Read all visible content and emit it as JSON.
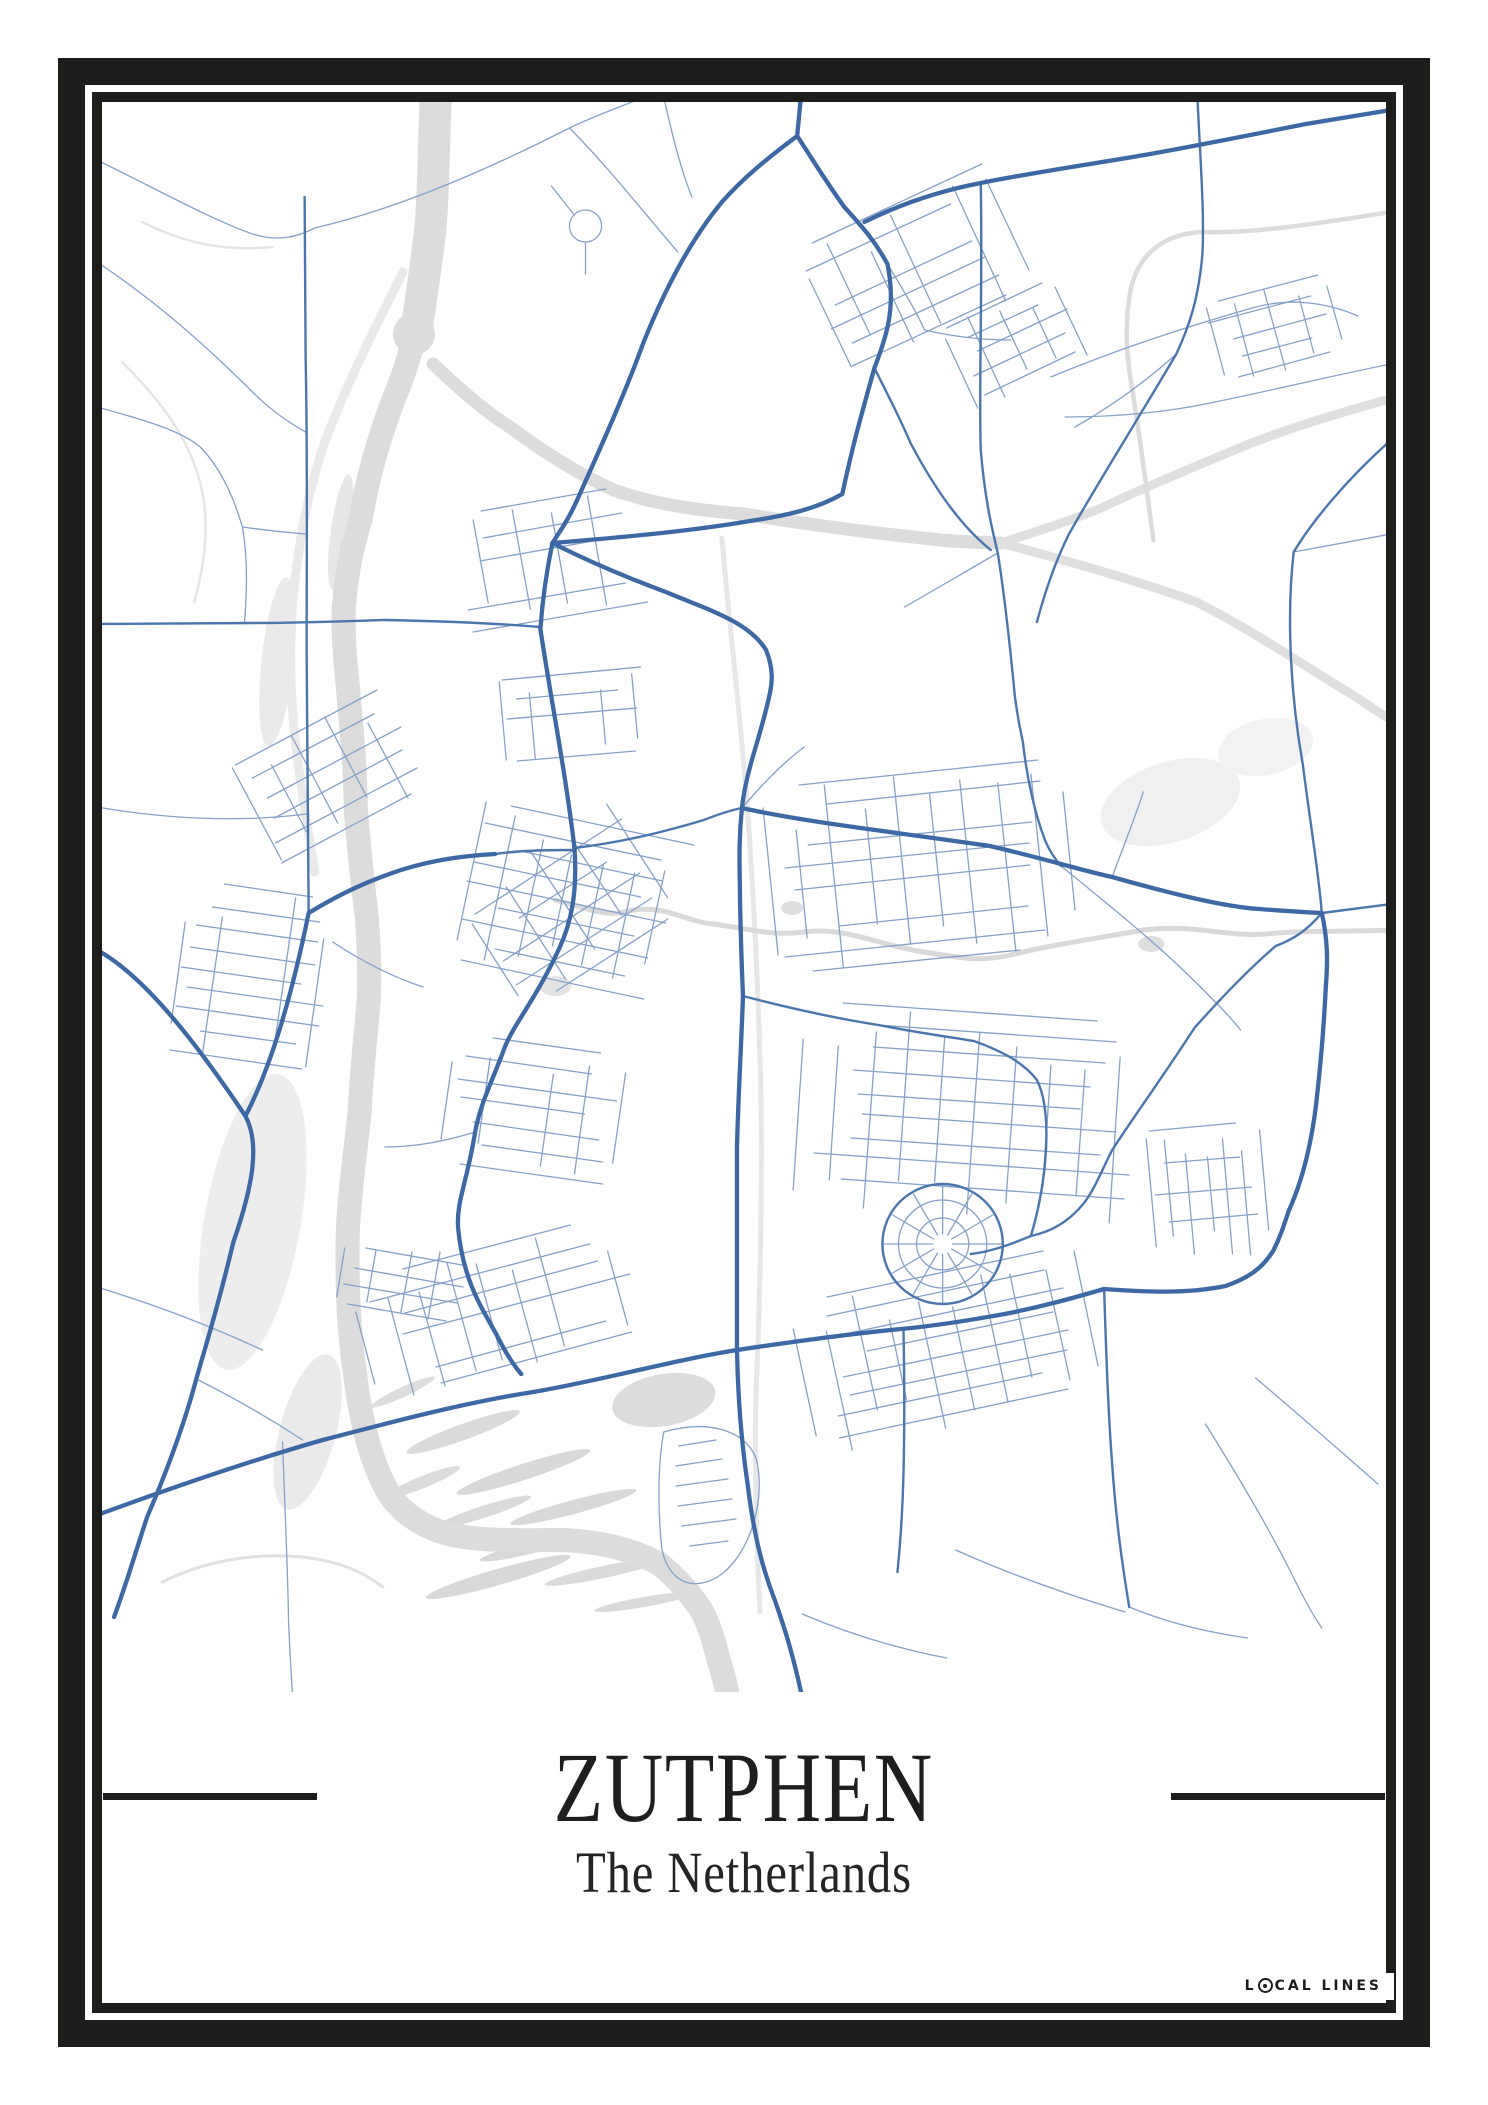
{
  "poster": {
    "title": "ZUTPHEN",
    "subtitle": "The Netherlands",
    "brand_pre": "L",
    "brand_post": "CAL LINES"
  },
  "colors": {
    "frame": "#1d1d1b",
    "text": "#1e1e1e",
    "background": "#ffffff",
    "road_major": "#3c69a5",
    "road_medium": "#4a76ad",
    "road_minor": "#86a0c8",
    "water_gray": "#dcdcdc"
  },
  "map": {
    "viewbox": "0 0 1280 1590",
    "fills": [
      {
        "cx": 311,
        "cy": 232,
        "rx": 21,
        "ry": 21,
        "rot": 0,
        "c": "#dcdcdc"
      },
      {
        "cx": 175,
        "cy": 560,
        "rx": 16,
        "ry": 85,
        "rot": 6,
        "c": "#eaeaea"
      },
      {
        "cx": 150,
        "cy": 1120,
        "rx": 48,
        "ry": 150,
        "rot": 10,
        "c": "#ededed"
      },
      {
        "cx": 205,
        "cy": 1330,
        "rx": 28,
        "ry": 80,
        "rot": 15,
        "c": "#eaeaea"
      },
      {
        "cx": 238,
        "cy": 430,
        "rx": 10,
        "ry": 58,
        "rot": 8,
        "c": "#e7e7e7"
      },
      {
        "cx": 360,
        "cy": 1330,
        "rx": 60,
        "ry": 8,
        "rot": -20,
        "c": "#dadada"
      },
      {
        "cx": 420,
        "cy": 1370,
        "rx": 70,
        "ry": 8,
        "rot": -18,
        "c": "#d8d8d8"
      },
      {
        "cx": 470,
        "cy": 1405,
        "rx": 65,
        "ry": 7,
        "rot": -15,
        "c": "#d8d8d8"
      },
      {
        "cx": 380,
        "cy": 1410,
        "rx": 50,
        "ry": 6,
        "rot": -18,
        "c": "#dadada"
      },
      {
        "cx": 430,
        "cy": 1445,
        "rx": 55,
        "ry": 6,
        "rot": -14,
        "c": "#d8d8d8"
      },
      {
        "cx": 500,
        "cy": 1470,
        "rx": 60,
        "ry": 6,
        "rot": -12,
        "c": "#dadada"
      },
      {
        "cx": 320,
        "cy": 1380,
        "rx": 40,
        "ry": 6,
        "rot": -22,
        "c": "#dcdcdc"
      },
      {
        "cx": 540,
        "cy": 1500,
        "rx": 50,
        "ry": 5,
        "rot": -10,
        "c": "#dadada"
      },
      {
        "cx": 300,
        "cy": 1290,
        "rx": 35,
        "ry": 5,
        "rot": -25,
        "c": "#dcdcdc"
      },
      {
        "cx": 395,
        "cy": 1475,
        "rx": 75,
        "ry": 8,
        "rot": -16,
        "c": "#d8d8d8"
      },
      {
        "cx": 560,
        "cy": 1298,
        "rx": 52,
        "ry": 26,
        "rot": -10,
        "c": "#dcdcdc"
      },
      {
        "cx": 452,
        "cy": 884,
        "rx": 16,
        "ry": 10,
        "rot": 0,
        "c": "#e3e3e3"
      },
      {
        "cx": 688,
        "cy": 806,
        "rx": 11,
        "ry": 7,
        "rot": 0,
        "c": "#dedede"
      },
      {
        "cx": 1046,
        "cy": 842,
        "rx": 13,
        "ry": 8,
        "rot": 0,
        "c": "#dedede"
      },
      {
        "cx": 1065,
        "cy": 700,
        "rx": 72,
        "ry": 40,
        "rot": -18,
        "c": "#f0f0f0"
      },
      {
        "cx": 1160,
        "cy": 645,
        "rx": 48,
        "ry": 28,
        "rot": -12,
        "c": "#f2f2f2"
      }
    ],
    "water": [
      {
        "d": "M333,-10 C330,50 331,90 327,130 C322,170 318,200 313,230",
        "w": 32,
        "c": "#dcdcdc"
      },
      {
        "d": "M332,-10 C329,60 334,100 326,126 C318,180 316,205 311,236 C300,280 290,296 284,316 C272,350 264,380 258,416 C248,450 244,470 241,506 C240,540 243,560 246,596 C250,640 252,660 253,706 C256,750 260,780 264,816 C266,845 267,865 266,896 C263,935 259,965 257,1007 C253,1050 247,1085 245,1130 C244,1180 246,1230 252,1270 C258,1320 268,1360 286,1392 C300,1412 320,1425 345,1432 C380,1440 420,1438 460,1438 C500,1440 530,1448 556,1462 C575,1478 585,1490 596,1506 C605,1520 610,1540 614,1555 C618,1570 622,1580 625,1600",
        "w": 24,
        "c": "#dcdcdc"
      },
      {
        "d": "M300,170 C270,230 245,280 222,340 C205,390 196,440 190,500 C186,550 188,600 194,650 C199,690 206,730 212,770",
        "w": 9,
        "c": "#eaeaea"
      },
      {
        "d": "M330,262 C360,290 380,308 408,326 C440,350 475,372 510,388 C550,402 590,408 640,412 C700,422 760,430 827,437 C850,440 870,440 896,441",
        "w": 13,
        "c": "#dcdcdc"
      },
      {
        "d": "M896,441 C930,430 962,420 996,406 C1040,385 1100,360 1146,341 C1185,326 1220,315 1280,298",
        "w": 9,
        "c": "#dfdfdf"
      },
      {
        "d": "M896,441 C960,458 1030,478 1091,500 C1150,530 1200,565 1250,595 C1262,603 1272,610 1285,618",
        "w": 9,
        "c": "#dfdfdf"
      },
      {
        "d": "M618,436 C625,520 635,600 643,700 C650,800 655,900 657,1000 C658,1100 656,1200 652,1290 C650,1360 652,1430 656,1510",
        "w": 5,
        "c": "#e7e7e7"
      },
      {
        "d": "M1285,110 C1220,120 1150,132 1096,130 C1060,132 1035,150 1026,185 C1018,225 1022,260 1028,293 C1035,340 1042,390 1048,438",
        "w": 4.5,
        "c": "#dcdcdc"
      },
      {
        "d": "M452,798 C480,805 500,815 520,810 C560,800 580,820 610,822 C650,828 668,834 700,830 C740,824 780,845 820,850 C860,857 879,860 910,852 C950,842 1000,835 1038,828 C1090,822 1120,835 1160,832 C1200,828 1240,830 1285,828",
        "w": 5,
        "c": "#d9d9d9"
      },
      {
        "d": "M20,260 C60,300 90,340 100,390 C108,430 100,470 92,500",
        "w": 2.5,
        "c": "#e5e5e5"
      },
      {
        "d": "M40,120 C80,140 120,150 170,145",
        "w": 2.5,
        "c": "#e5e5e5"
      },
      {
        "d": "M60,1480 C100,1460 150,1450 200,1455 C240,1460 260,1470 280,1485",
        "w": 3,
        "c": "#e1e1e1"
      }
    ],
    "major": [
      "M697,-8 L693,34",
      "M693,34 C665,55 640,75 618,100 C585,140 560,190 540,240 C520,295 495,350 475,395 C465,418 456,430 449,441",
      "M693,34 C710,60 722,80 740,105 C758,125 770,138 783,162 C792,205 782,235 770,266 C755,320 748,345 738,392 C710,408 680,414 640,420 C580,430 510,436 449,441",
      "M760,120 C800,100 840,88 876,81 C930,70 1000,60 1039,53 C1090,44 1150,32 1200,22 L1285,8",
      "M449,441 C490,462 530,478 562,490 C605,508 645,520 662,548 C670,568 668,582 665,595 C655,640 643,665 638,705 C634,745 636,770 636,796 C637,850 638,870 639,894 C637,950 634,1000 633,1046 C633,1120 633,1180 633,1248 C634,1300 638,1345 644,1385 C650,1435 659,1468 671,1499 C679,1522 687,1545 698,1595",
      "M449,441 C443,470 439,500 437,527 C448,600 462,670 471,746 C474,790 468,820 456,846 C432,898 412,920 402,944 C388,982 377,1002 372,1030 C364,1080 353,1100 355,1126 C360,1180 380,1208 394,1234 C402,1250 409,1262 418,1272",
      "M-5,848 C45,875 100,950 143,1014 C158,1042 150,1085 131,1140 C113,1215 102,1248 94,1277 C80,1330 60,1380 45,1415 C35,1445 25,1480 12,1515",
      "M143,1014 C172,958 192,880 206,811 C240,790 268,778 298,768 C330,758 358,754 392,752",
      "M-2,1412 C80,1382 150,1358 220,1338 C300,1317 365,1300 430,1290 C500,1278 570,1258 633,1248 C700,1238 762,1230 807,1226 C852,1221 876,1216 900,1212 C940,1204 968,1196 999,1187",
      "M638,706 C700,720 790,730 885,744 C945,758 975,768 1007,775 C1060,790 1118,805 1154,807 C1178,809 1196,810 1216,811 C1222,838 1222,860 1220,885 C1218,925 1216,950 1212,987 C1207,1040 1196,1080 1183,1109 C1177,1127 1174,1136 1168,1148 C1156,1168 1140,1177 1120,1184 C1082,1192 1040,1190 999,1187"
    ],
    "medium": [
      "M770,266 C788,302 798,322 806,341 C838,402 866,432 886,448",
      "M876,81 C878,180 874,280 876,348 C880,395 886,422 893,451 C901,502 906,552 910,594 C913,618 916,630 918,640 C922,676 930,712 940,738 C944,748 950,757 956,764",
      "M1092,-5 C1095,60 1099,110 1097,152 C1093,200 1082,228 1071,252 C1025,330 992,382 964,432 C950,460 940,490 932,520",
      "M1285,338 C1240,378 1206,420 1188,450 C1180,520 1186,600 1197,662 C1206,732 1213,772 1216,811",
      "M1216,811 L1285,802",
      "M639,894 C700,910 742,918 774,923 C820,932 852,936 869,939 C900,950 920,962 932,978 C948,1010 942,1080 926,1134",
      "M1216,811 C1200,830 1186,838 1170,844 C1140,870 1112,900 1089,926 C1062,968 1032,1010 1007,1048 C996,1070 990,1086 979,1101 C962,1122 944,1130 926,1134 C902,1144 884,1150 866,1152",
      "M202,95 C203,180 203,220 203,257 C205,350 204,450 204,550 C204,650 205,740 206,811",
      "M-5,522 L150,521 C200,521 245,519 282,518 C330,519 390,521 437,525",
      "M999,1187 C1001,1250 1003,1310 1007,1362 C1011,1420 1017,1462 1024,1505",
      "M799,1228 C800,1280 800,1330 799,1372 C798,1412 796,1440 793,1470",
      "M392,752 C420,748 448,748 471,748",
      "M471,746 C520,740 560,730 600,718 C615,712 628,708 638,706",
      "M838,1142 m-60,0 a60,60 0 1,0 120,0 a60,60 0 1,0 -120,0"
    ],
    "minor": [
      "M-5,58 C60,90 110,118 150,132 C175,140 195,135 212,126",
      "M212,126 C290,108 380,70 466,26 C495,12 520,4 540,-5",
      "M466,26 C500,60 540,110 574,150",
      "M-5,305 C50,320 80,330 98,345 C120,368 132,398 140,425 C146,460 144,495 142,522",
      "M140,425 C175,430 192,431 203,432",
      "M-5,160 C55,200 105,245 150,290 C168,308 185,320 203,330",
      "M482,124 m-16,0 a16,16 0 1,0 32,0 a16,16 0 1,0 -32,0 M482,140 L482,172 M470,112 L448,84",
      "M560,-5 C570,40 578,70 588,95",
      "M946,275 C1010,248 1080,225 1150,205 C1185,196 1220,200 1252,214",
      "M1285,262 C1220,275 1160,290 1100,302 C1050,312 1000,315 960,315",
      "M1071,252 C1040,280 1005,305 970,325",
      "M1285,432 L1188,450",
      "M956,764 C1000,800 1050,840 1090,880 C1110,900 1124,914 1135,928",
      "M1150,1276 C1190,1310 1230,1345 1272,1382",
      "M1100,1322 C1130,1370 1160,1420 1185,1470 C1196,1492 1205,1510 1216,1526",
      "M1024,1505 C1060,1520 1100,1530 1142,1536",
      "M698,1512 C740,1530 790,1546 842,1556",
      "M851,1448 C900,1470 960,1492 1020,1510",
      "M-5,1185 C60,1205 110,1225 160,1248",
      "M94,1277 C130,1295 165,1315 200,1338",
      "M-5,705 C70,718 140,720 204,712",
      "M180,1340 C182,1400 185,1460 186,1520 C187,1545 188,1560 190,1595",
      "M560,1330 C600,1318 640,1326 652,1356 C662,1395 648,1448 618,1472 C590,1492 564,1480 558,1446 C554,1408 554,1362 560,1330 M575,1344 L612,1338 M572,1364 L618,1357 M572,1384 L624,1377 M574,1404 L628,1397 M578,1424 L632,1417 M586,1444 L624,1439",
      "M372,1030 C340,1040 310,1045 282,1045",
      "M230,840 C260,860 290,875 320,885",
      "M783,162 C800,190 812,210 820,228 M820,228 C850,235 880,238 906,238",
      "M1007,775 C1020,740 1030,715 1038,690",
      "M893,451 C860,470 830,488 800,505",
      "M638,706 C660,680 680,660 700,645",
      "M848,1142 L896,1142 M847,1147 L888,1171 M843,1151 L867,1192 M838,1152 L838,1200 M833,1151 L809,1192 M829,1147 L788,1171 M828,1142 L780,1142 M829,1137 L788,1113 M833,1133 L809,1092 M838,1132 L838,1084 M843,1133 L867,1092 M847,1137 L888,1113",
      "M838,1142 m-26,0 a26,26 0 1,0 52,0 a26,26 0 1,0 -52,0 M838,1142 m-44,0 a44,44 0 1,0 88,0 a44,44 0 1,0 -88,0"
    ],
    "grids": [
      {
        "cx": 800,
        "cy": 178,
        "w": 240,
        "h": 140,
        "a": -25,
        "step": 21
      },
      {
        "cx": 1168,
        "cy": 228,
        "w": 122,
        "h": 84,
        "a": -15,
        "step": 19
      },
      {
        "cx": 442,
        "cy": 458,
        "w": 195,
        "h": 115,
        "a": -10,
        "step": 23
      },
      {
        "cx": 472,
        "cy": 612,
        "w": 150,
        "h": 85,
        "a": -5,
        "step": 21
      },
      {
        "cx": 468,
        "cy": 802,
        "w": 215,
        "h": 165,
        "a": 12,
        "step": 20
      },
      {
        "cx": 468,
        "cy": 800,
        "w": 185,
        "h": 140,
        "a": -33,
        "step": 27
      },
      {
        "cx": 432,
        "cy": 1012,
        "w": 175,
        "h": 135,
        "a": 8,
        "step": 21
      },
      {
        "cx": 228,
        "cy": 674,
        "w": 170,
        "h": 112,
        "a": -28,
        "step": 22
      },
      {
        "cx": 152,
        "cy": 882,
        "w": 150,
        "h": 185,
        "a": 8,
        "step": 21
      },
      {
        "cx": 818,
        "cy": 768,
        "w": 305,
        "h": 195,
        "a": -6,
        "step": 21
      },
      {
        "cx": 868,
        "cy": 1018,
        "w": 345,
        "h": 215,
        "a": 4,
        "step": 22
      },
      {
        "cx": 848,
        "cy": 1248,
        "w": 300,
        "h": 155,
        "a": -12,
        "step": 20
      },
      {
        "cx": 1102,
        "cy": 1092,
        "w": 132,
        "h": 118,
        "a": 85,
        "step": 19
      },
      {
        "cx": 400,
        "cy": 1210,
        "w": 280,
        "h": 130,
        "a": -15,
        "step": 20
      },
      {
        "cx": 300,
        "cy": 1180,
        "w": 120,
        "h": 90,
        "a": 10,
        "step": 19
      },
      {
        "cx": 912,
        "cy": 242,
        "w": 125,
        "h": 92,
        "a": -25,
        "step": 19
      }
    ]
  }
}
